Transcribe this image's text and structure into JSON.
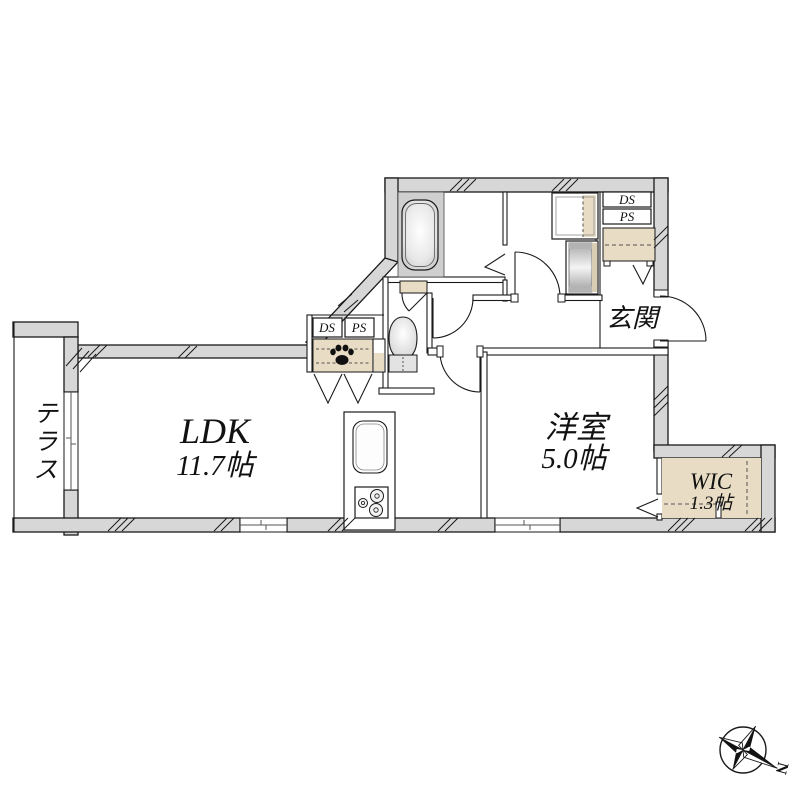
{
  "rooms": {
    "ldk": {
      "label": "LDK",
      "area": "11.7帖"
    },
    "youshitsu": {
      "label": "洋室",
      "area": "5.0帖"
    },
    "wic": {
      "label": "WIC",
      "area": "1.3帖"
    },
    "genkan": {
      "label": "玄関"
    },
    "terrace": {
      "label": "テラス"
    }
  },
  "shafts": {
    "ds": "DS",
    "ps": "PS"
  },
  "compass": {
    "north_label": "N"
  },
  "colors": {
    "wall_gray": "#d7d7d7",
    "outline": "#1a1a1a",
    "storage_beige": "#e8dcc4",
    "bath_floor": "#cfcfcf"
  }
}
